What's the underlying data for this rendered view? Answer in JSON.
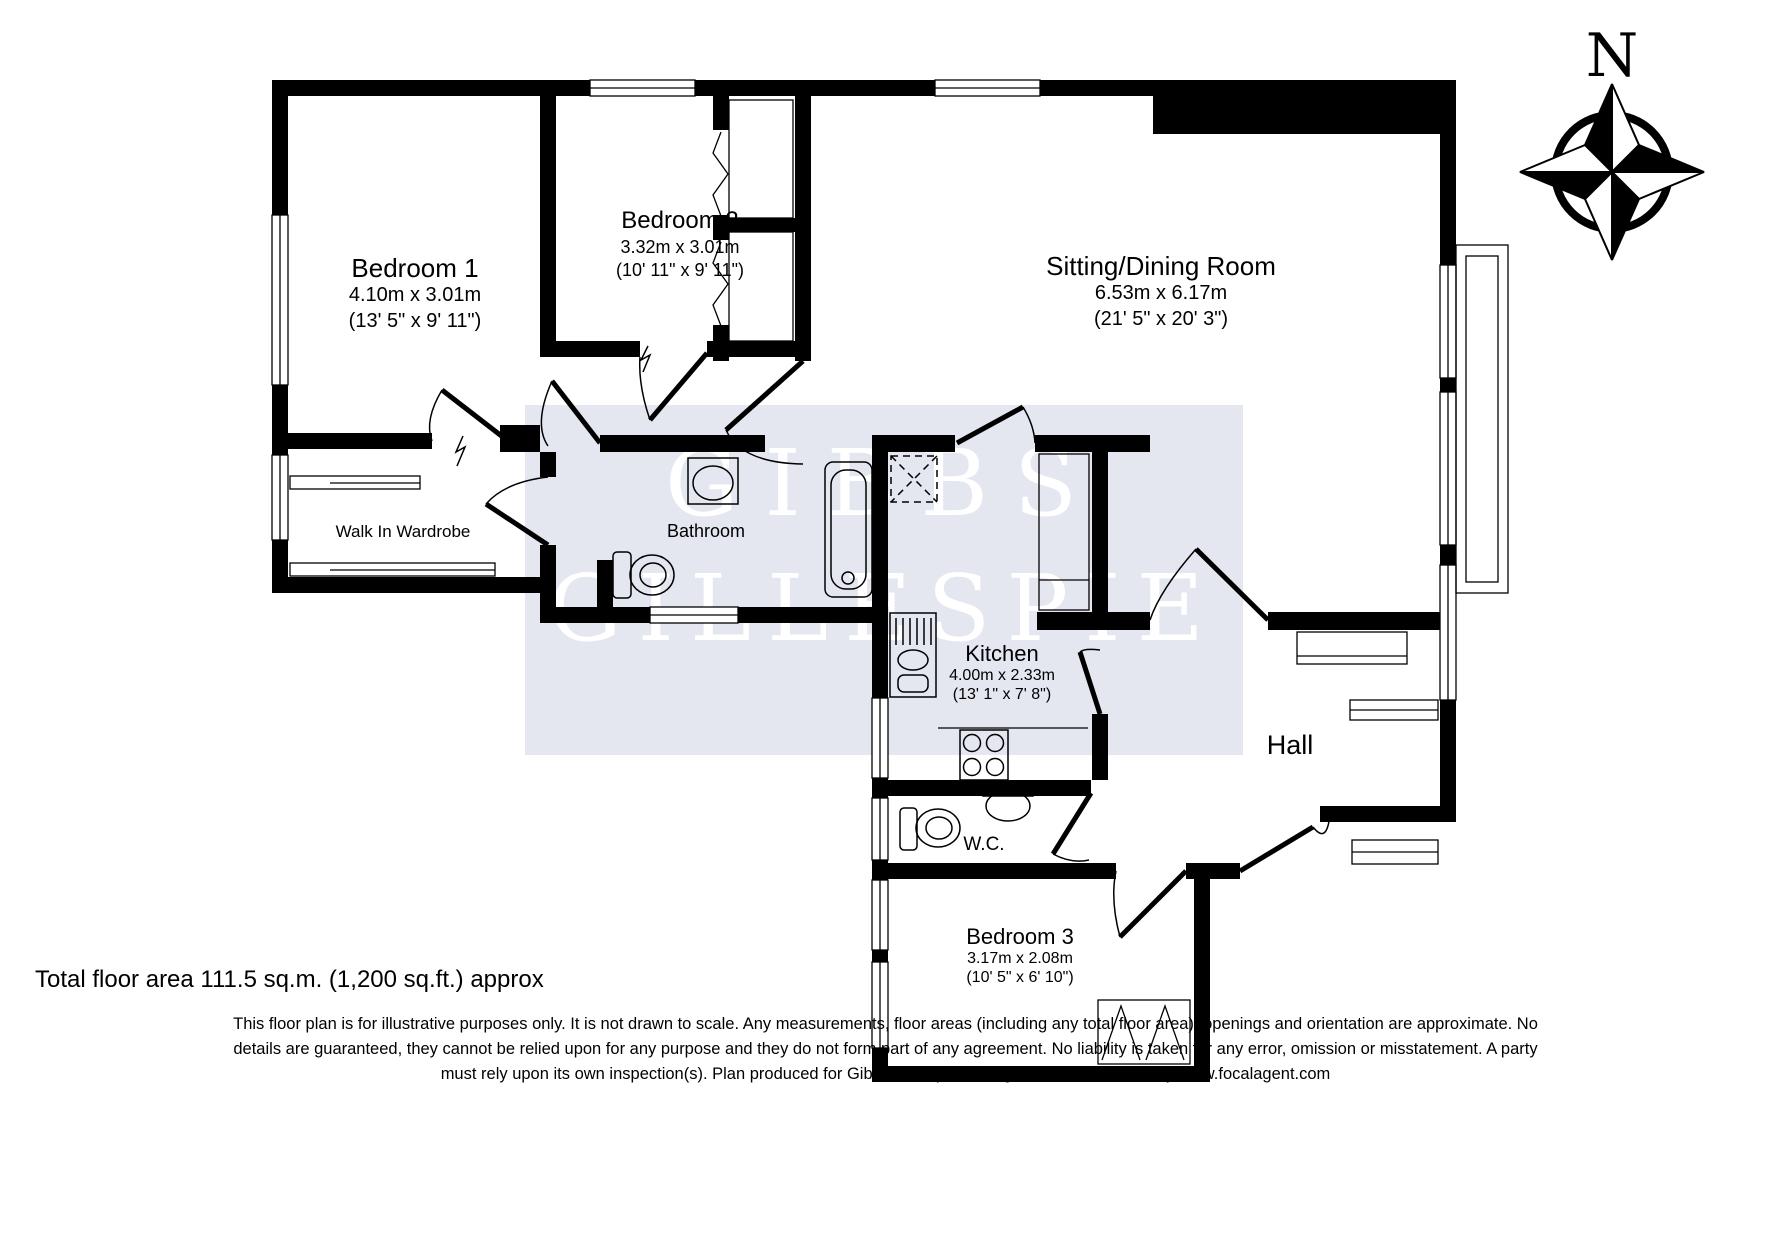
{
  "watermark": {
    "line1": "GIBBS",
    "line2": "GILLESPIE"
  },
  "compass": {
    "north_label": "N"
  },
  "rooms": {
    "bedroom1": {
      "name": "Bedroom 1",
      "dims_metric": "4.10m x 3.01m",
      "dims_imperial": "(13' 5\" x 9' 11\")"
    },
    "bedroom2": {
      "name": "Bedroom 2",
      "dims_metric": "3.32m x 3.01m",
      "dims_imperial": "(10' 11\" x 9' 11\")"
    },
    "sitting_dining": {
      "name": "Sitting/Dining Room",
      "dims_metric": "6.53m x 6.17m",
      "dims_imperial": "(21' 5\" x 20' 3\")"
    },
    "walk_in_wardrobe": {
      "name": "Walk In Wardrobe"
    },
    "bathroom": {
      "name": "Bathroom"
    },
    "kitchen": {
      "name": "Kitchen",
      "dims_metric": "4.00m x 2.33m",
      "dims_imperial": "(13' 1\" x 7' 8\")"
    },
    "hall": {
      "name": "Hall"
    },
    "wc": {
      "name": "W.C."
    },
    "bedroom3": {
      "name": "Bedroom 3",
      "dims_metric": "3.17m x 2.08m",
      "dims_imperial": "(10' 5\" x 6' 10\")"
    }
  },
  "footer": {
    "total_area": "Total floor area 111.5 sq.m. (1,200 sq.ft.) approx",
    "disclaimer_line1": "This floor plan is for illustrative purposes only. It is not drawn to scale. Any measurements, floor areas (including any total floor area), openings and orientation are approximate. No",
    "disclaimer_line2": "details are guaranteed, they cannot be relied upon for any purpose and they do not form part of any agreement. No liability is taken for any error, omission or misstatement. A party",
    "disclaimer_line3": "must rely upon its own inspection(s). Plan produced for Gibbs Gillespie Lettings Limited. Powered by www.focalagent.com"
  },
  "colors": {
    "wall": "#000000",
    "watermark_box": "#E4E7F0",
    "watermark_text": "#FFFFFF"
  }
}
